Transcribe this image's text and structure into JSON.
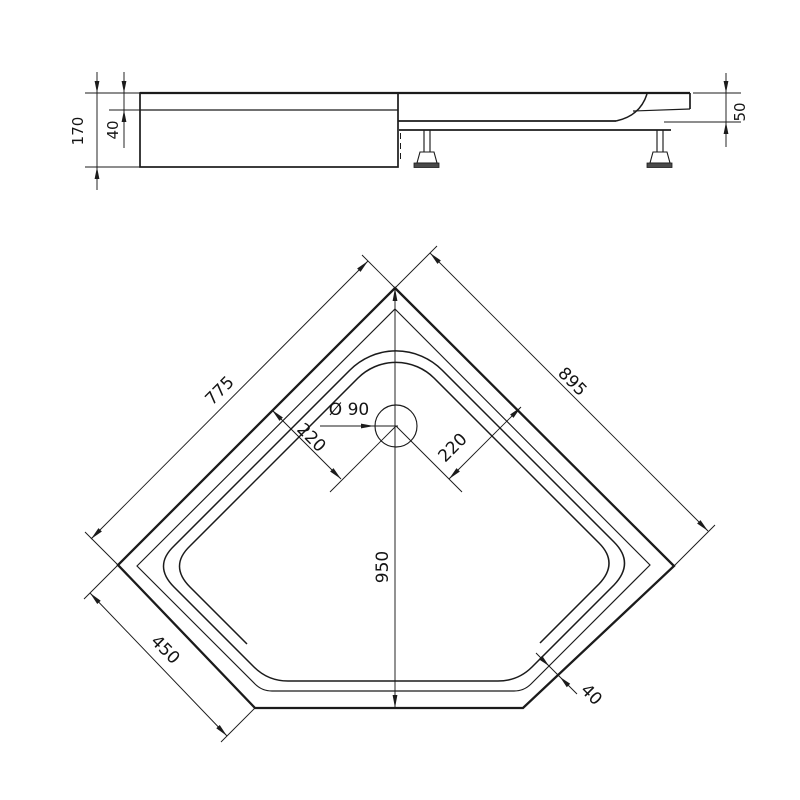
{
  "title": "Shower tray technical drawing",
  "units": "mm",
  "colors": {
    "line": "#1b1b1b",
    "background": "#ffffff",
    "foot_plate": "#4a4a4a"
  },
  "side_view": {
    "dims": {
      "total_height": "170",
      "rim_height": "40",
      "right_end_height": "50"
    }
  },
  "plan_view": {
    "dims": {
      "left_edge": "775",
      "right_edge": "895",
      "drain_diameter": "Ø 90",
      "drain_offset_left": "220",
      "drain_offset_right": "220",
      "depth": "950",
      "front_left_edge": "450",
      "rim_width": "40"
    }
  }
}
